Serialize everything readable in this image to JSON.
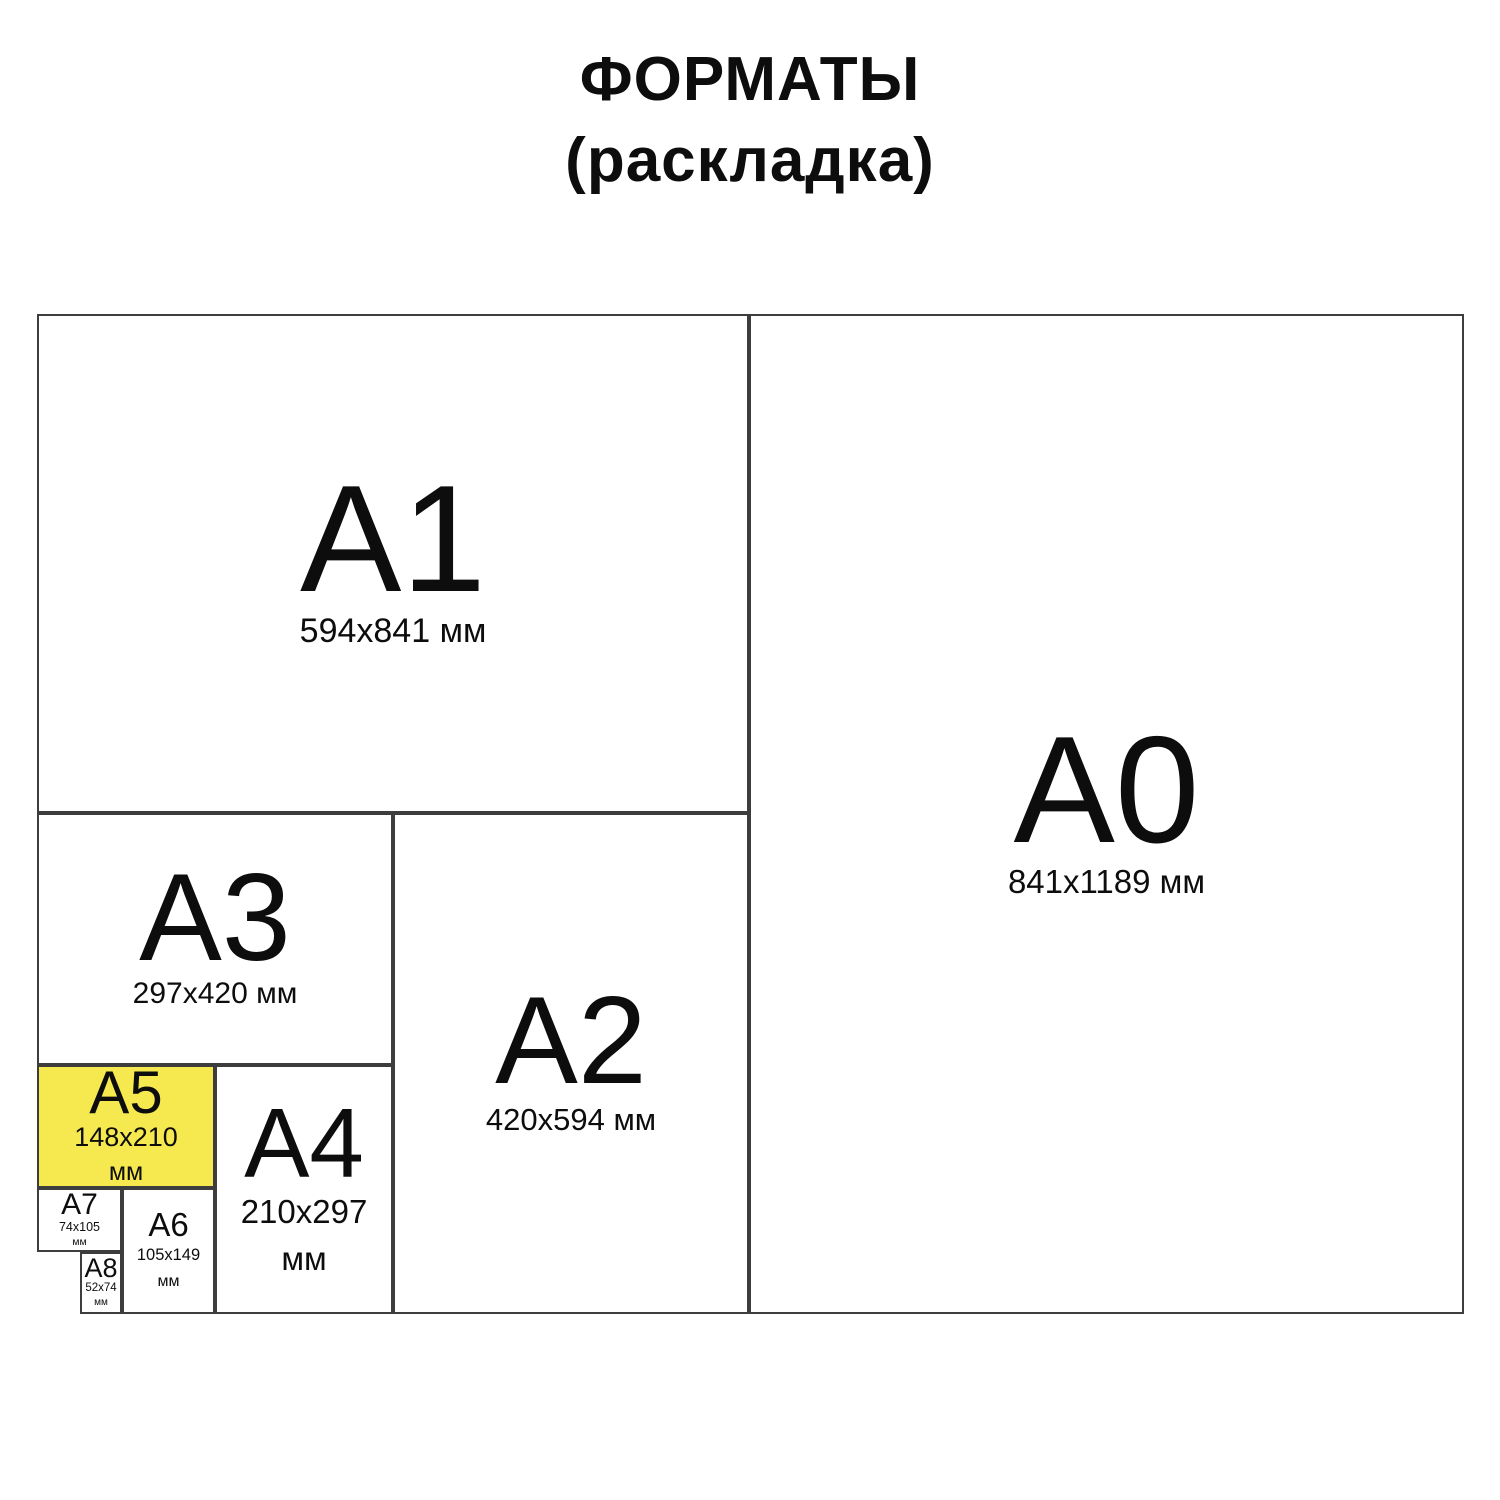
{
  "title": {
    "line1": "ФОРМАТЫ",
    "line2": "(раскладка)"
  },
  "colors": {
    "highlight_yellow": "#f6e94f",
    "line": "#3d3d3d",
    "text": "#0d0d0d",
    "background": "#ffffff"
  },
  "cells": {
    "a1": {
      "label": "A1",
      "dims": "594x841 мм"
    },
    "a0": {
      "label": "A0",
      "dims": "841x1189 мм"
    },
    "a3": {
      "label": "A3",
      "dims": "297x420 мм"
    },
    "a2": {
      "label": "A2",
      "dims": "420x594 мм"
    },
    "a5": {
      "label": "A5",
      "size": "148x210",
      "unit": "мм",
      "highlighted": true
    },
    "a4": {
      "label": "A4",
      "size": "210x297",
      "unit": "мм"
    },
    "a7": {
      "label": "A7",
      "size": "74x105",
      "unit": "мм"
    },
    "a6": {
      "label": "A6",
      "size": "105x149",
      "unit": "мм"
    },
    "a8": {
      "label": "A8",
      "size": "52x74",
      "unit": "мм"
    }
  }
}
